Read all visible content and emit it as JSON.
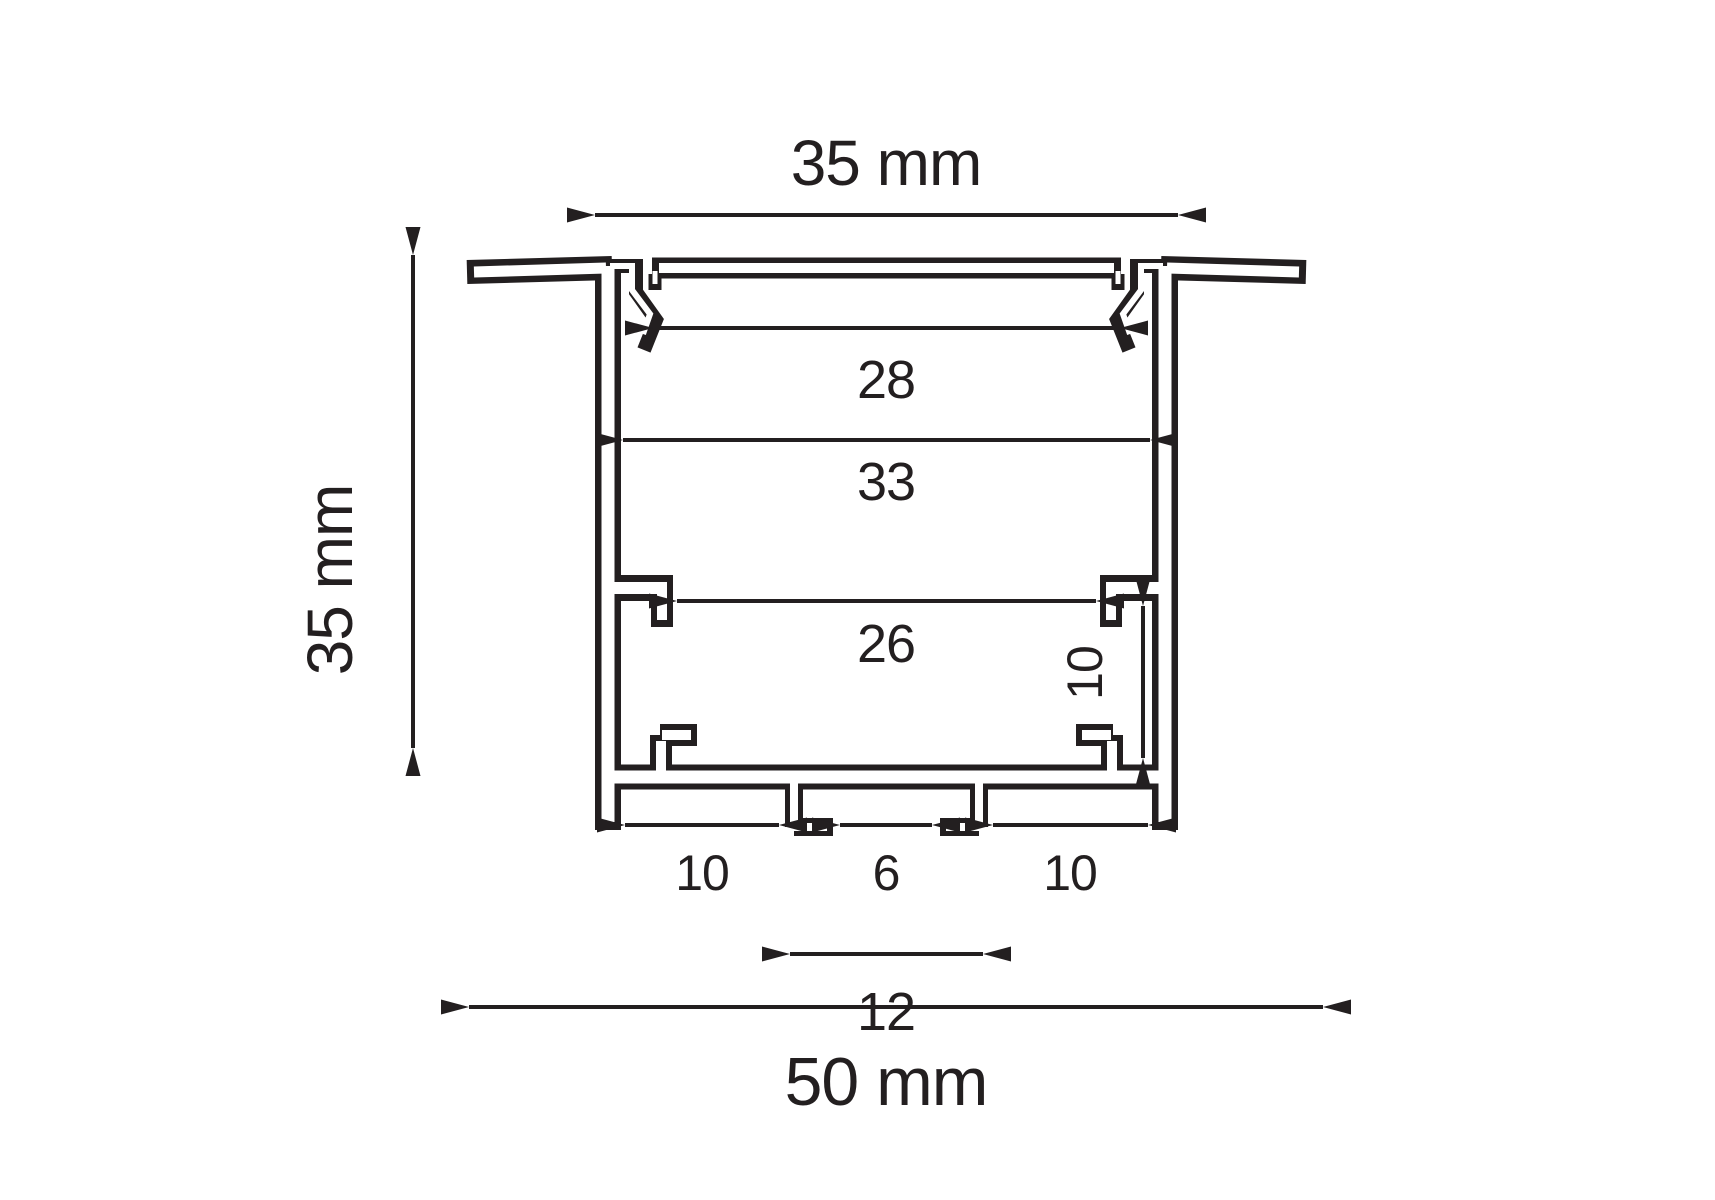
{
  "drawing": {
    "type": "profile-cross-section-dimension-drawing",
    "units": "mm",
    "colors": {
      "line": "#231f20",
      "background": "#ffffff"
    },
    "dimensions": {
      "body_width": "35 mm",
      "body_height": "35 mm",
      "cover_opening_width": "28",
      "inner_cavity_width": "33",
      "hook_to_hook_width": "26",
      "side_pocket_height": "10",
      "bottom_pocket_left_width": "10",
      "screw_slot_gap": "6",
      "bottom_pocket_right_width": "10",
      "screw_boss_outer_width": "12",
      "overall_width": "50 mm"
    }
  }
}
